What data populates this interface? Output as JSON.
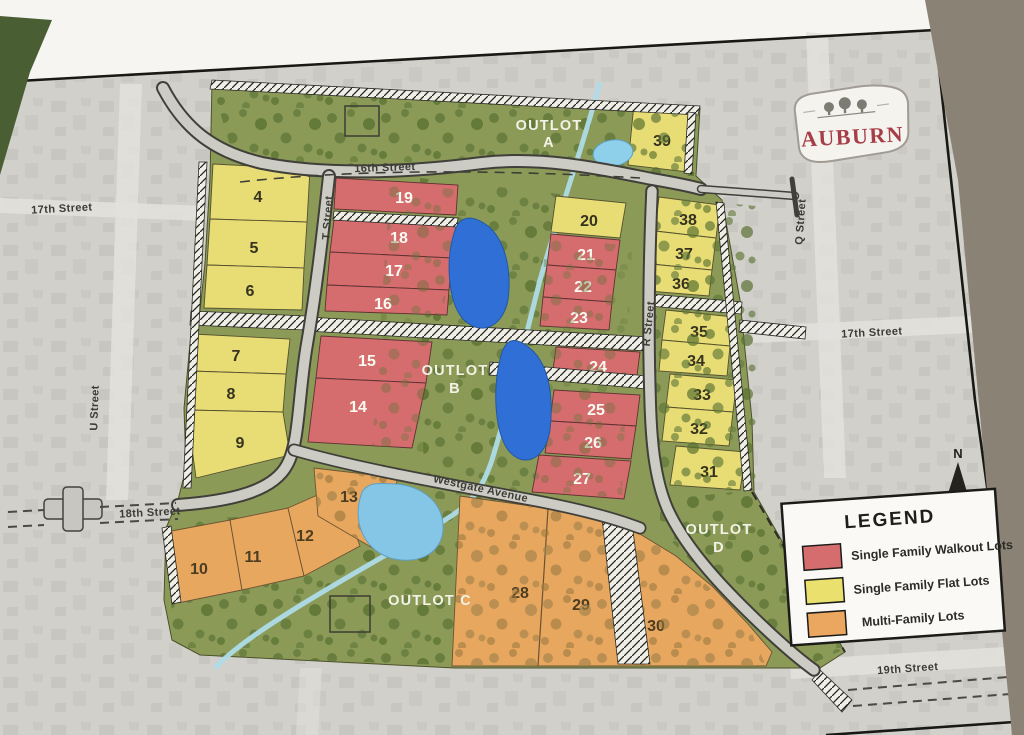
{
  "logo": {
    "name": "AUBURN"
  },
  "compass": {
    "label": "N"
  },
  "legend": {
    "title": "LEGEND",
    "items": [
      {
        "label": "Single Family Walkout Lots",
        "color": "#d56c6e"
      },
      {
        "label": "Single Family Flat Lots",
        "color": "#e9e06e"
      },
      {
        "label": "Multi-Family Lots",
        "color": "#eba75f"
      }
    ]
  },
  "streets": {
    "s16": "16th Street",
    "s17_left": "17th Street",
    "s17_right": "17th Street",
    "s18": "18th Street",
    "s19": "19th Street",
    "u": "U Street",
    "t": "T Street",
    "r": "R Street",
    "q": "Q Street",
    "westgate": "Westgate Avenue"
  },
  "outlots": {
    "word": "OUTLOT",
    "a": "A",
    "b": "B",
    "c": "OUTLOT C",
    "d": "D"
  },
  "lots": [
    {
      "n": "4",
      "type": "flat"
    },
    {
      "n": "5",
      "type": "flat"
    },
    {
      "n": "6",
      "type": "flat"
    },
    {
      "n": "7",
      "type": "flat"
    },
    {
      "n": "8",
      "type": "flat"
    },
    {
      "n": "9",
      "type": "flat"
    },
    {
      "n": "10",
      "type": "multi"
    },
    {
      "n": "11",
      "type": "multi"
    },
    {
      "n": "12",
      "type": "multi"
    },
    {
      "n": "13",
      "type": "multi"
    },
    {
      "n": "14",
      "type": "walkout"
    },
    {
      "n": "15",
      "type": "walkout"
    },
    {
      "n": "16",
      "type": "walkout"
    },
    {
      "n": "17",
      "type": "walkout"
    },
    {
      "n": "18",
      "type": "walkout"
    },
    {
      "n": "19",
      "type": "walkout"
    },
    {
      "n": "20",
      "type": "flat"
    },
    {
      "n": "21",
      "type": "walkout"
    },
    {
      "n": "22",
      "type": "walkout"
    },
    {
      "n": "23",
      "type": "walkout"
    },
    {
      "n": "24",
      "type": "walkout"
    },
    {
      "n": "25",
      "type": "walkout"
    },
    {
      "n": "26",
      "type": "walkout"
    },
    {
      "n": "27",
      "type": "walkout"
    },
    {
      "n": "28",
      "type": "multi"
    },
    {
      "n": "29",
      "type": "multi"
    },
    {
      "n": "30",
      "type": "multi"
    },
    {
      "n": "31",
      "type": "flat"
    },
    {
      "n": "32",
      "type": "flat"
    },
    {
      "n": "33",
      "type": "flat"
    },
    {
      "n": "34",
      "type": "flat"
    },
    {
      "n": "35",
      "type": "flat"
    },
    {
      "n": "36",
      "type": "flat"
    },
    {
      "n": "37",
      "type": "flat"
    },
    {
      "n": "38",
      "type": "flat"
    },
    {
      "n": "39",
      "type": "flat"
    }
  ],
  "palette": {
    "walkout_red": "#d56c6e",
    "flat_yellow": "#e8dc74",
    "multi_orange": "#e7a75f",
    "outlot_green": "#8c9a58",
    "pond_blue": "#2f6fd6",
    "pond_light": "#8ccfe9",
    "road_gray": "#ccccc5",
    "aerial_gray": "#d1d0cb"
  }
}
